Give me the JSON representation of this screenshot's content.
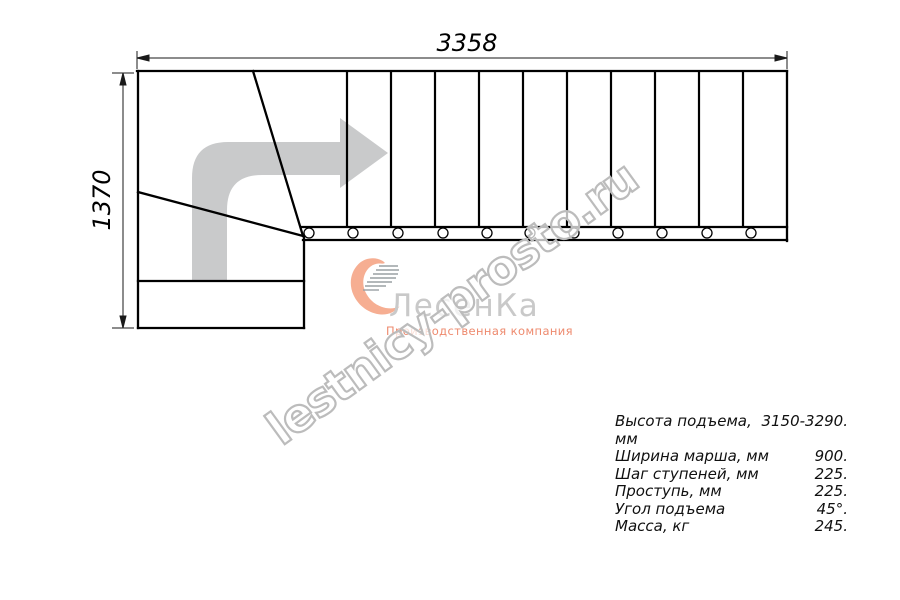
{
  "drawing": {
    "type": "staircase-plan-view",
    "straight_treads": 11,
    "winder_treads": 3,
    "balusters": 11,
    "direction_arrow": "up-then-right"
  },
  "dimensions": {
    "width_label": "3358",
    "height_label": "1370"
  },
  "specs": {
    "rows": [
      {
        "label": "Высота подъема, мм",
        "value": "3150-3290."
      },
      {
        "label": "Ширина марша, мм",
        "value": "900."
      },
      {
        "label": "Шаг ступеней, мм",
        "value": "225."
      },
      {
        "label": "Проступь, мм",
        "value": "225."
      },
      {
        "label": "Угол подъема",
        "value": "45°."
      },
      {
        "label": "Масса, кг",
        "value": "245."
      }
    ]
  },
  "watermark": {
    "text": "lestnicy-prosto.ru",
    "color": "#bcbcbc"
  },
  "logo": {
    "title": "ЛесенКа",
    "tagline": "Производственная компания",
    "mark": "heart-stairs-swoosh",
    "accent_color": "#f6ae92",
    "title_color": "#c9c9c9",
    "tagline_color": "#ee8a6e"
  },
  "colors": {
    "line": "#000000",
    "dim_line": "#1a1a1a",
    "arrow": "#c9cacb",
    "background": "#ffffff"
  }
}
